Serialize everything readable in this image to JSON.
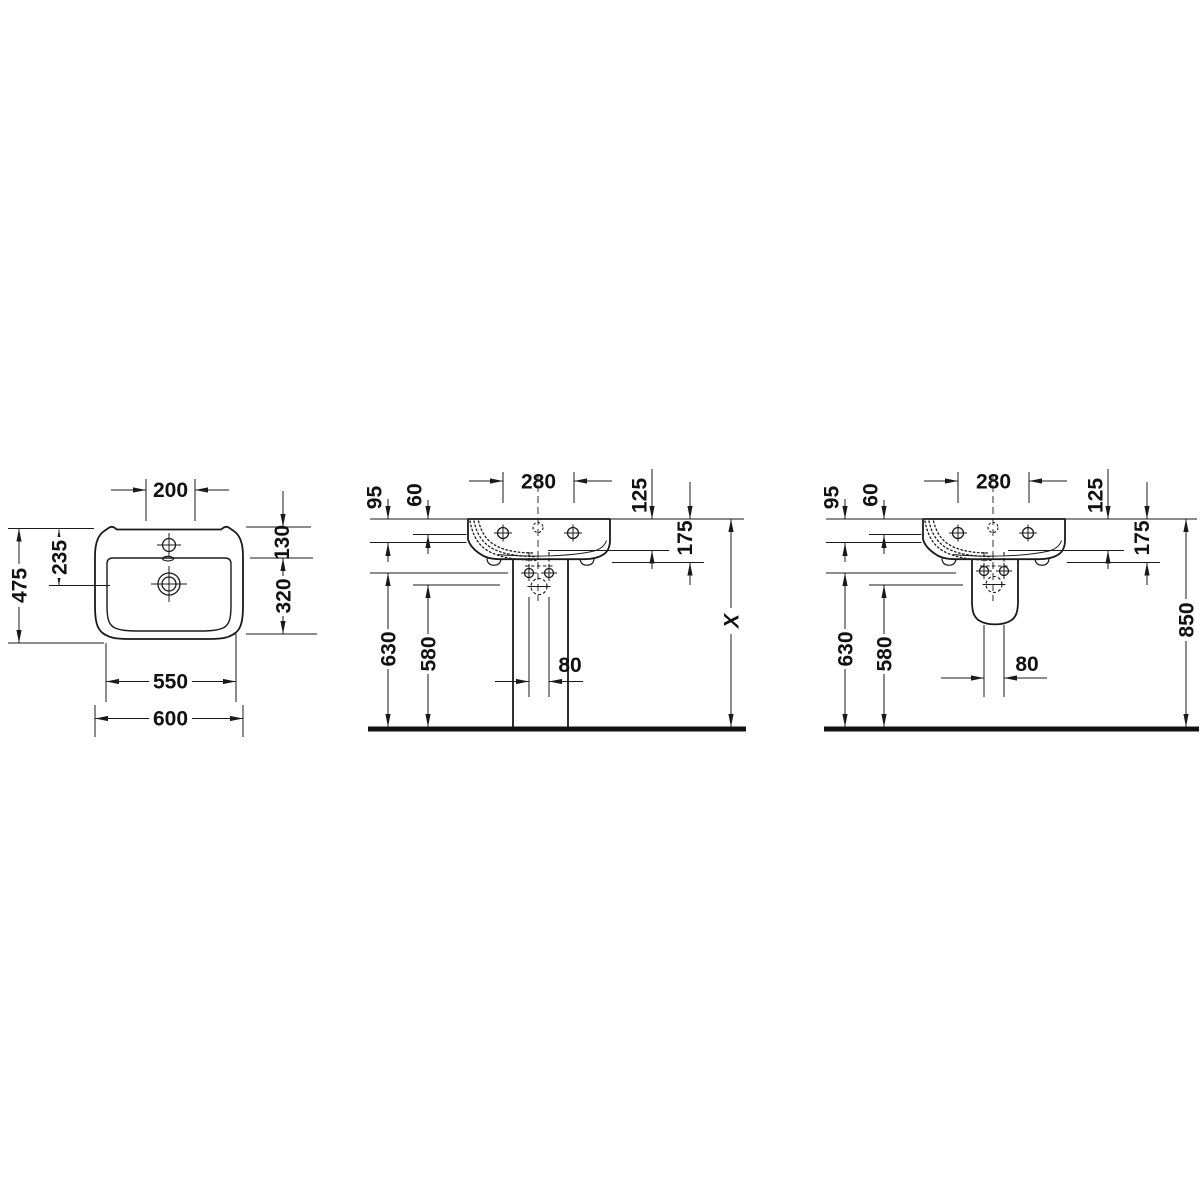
{
  "drawing": {
    "views": {
      "plan": {
        "dims": {
          "tap_zone_width": "200",
          "overall_depth": "475",
          "back_to_drain": "235",
          "back_to_bowl": "130",
          "bowl_depth": "320",
          "front_width": "550",
          "overall_width": "600"
        }
      },
      "front_pedestal": {
        "dims": {
          "tap_hole_spacing": "280",
          "back_drop_outer": "95",
          "back_drop_inner": "60",
          "rim_to_underside_back": "125",
          "rim_to_underside_front": "175",
          "floor_to_underside": "630",
          "floor_to_fixing": "580",
          "outlet_width": "80",
          "rim_height": "X"
        }
      },
      "front_half_pedestal": {
        "dims": {
          "tap_hole_spacing": "280",
          "back_drop_outer": "95",
          "back_drop_inner": "60",
          "rim_to_underside_back": "125",
          "rim_to_underside_front": "175",
          "floor_to_underside": "630",
          "floor_to_fixing": "580",
          "outlet_width": "80",
          "rim_height": "850"
        }
      }
    }
  }
}
